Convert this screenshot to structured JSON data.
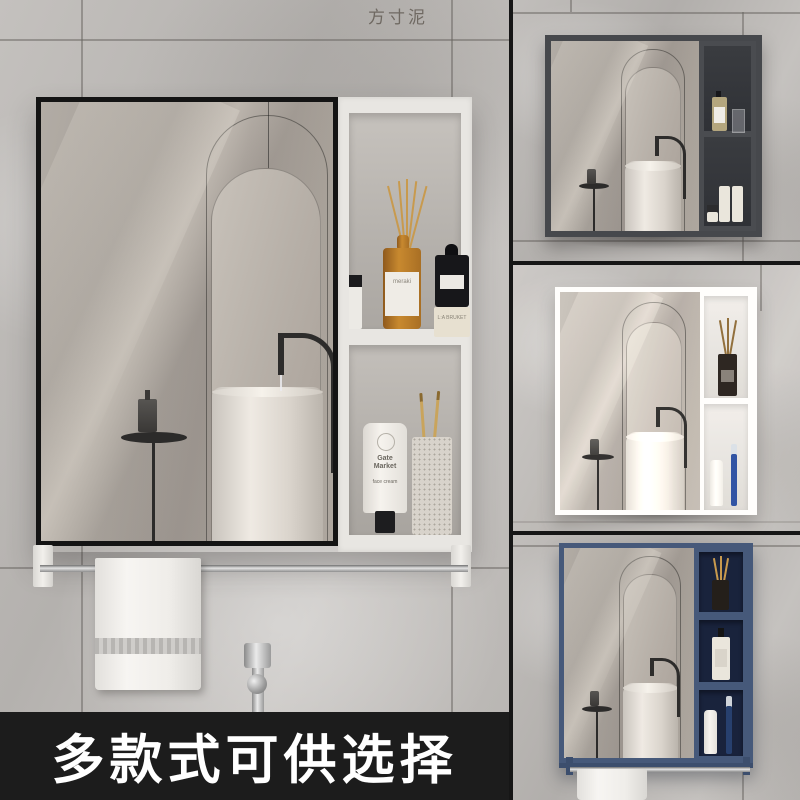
{
  "watermark": "方寸泥",
  "banner": {
    "text": "多款式可供选择"
  },
  "products": {
    "diffuser_label": "meraki",
    "jar_label": "L:A BRUKET",
    "tube_brand": "Gate Market",
    "tube_product": "face cream"
  },
  "colors": {
    "main_frame_black": "#141414",
    "variant_dark_gray": "#46484c",
    "variant_white": "#f1f0ee",
    "variant_navy_blue": "#46597a",
    "banner_bg": "#1c1c1c",
    "wall_gray": "#bdbab7"
  }
}
